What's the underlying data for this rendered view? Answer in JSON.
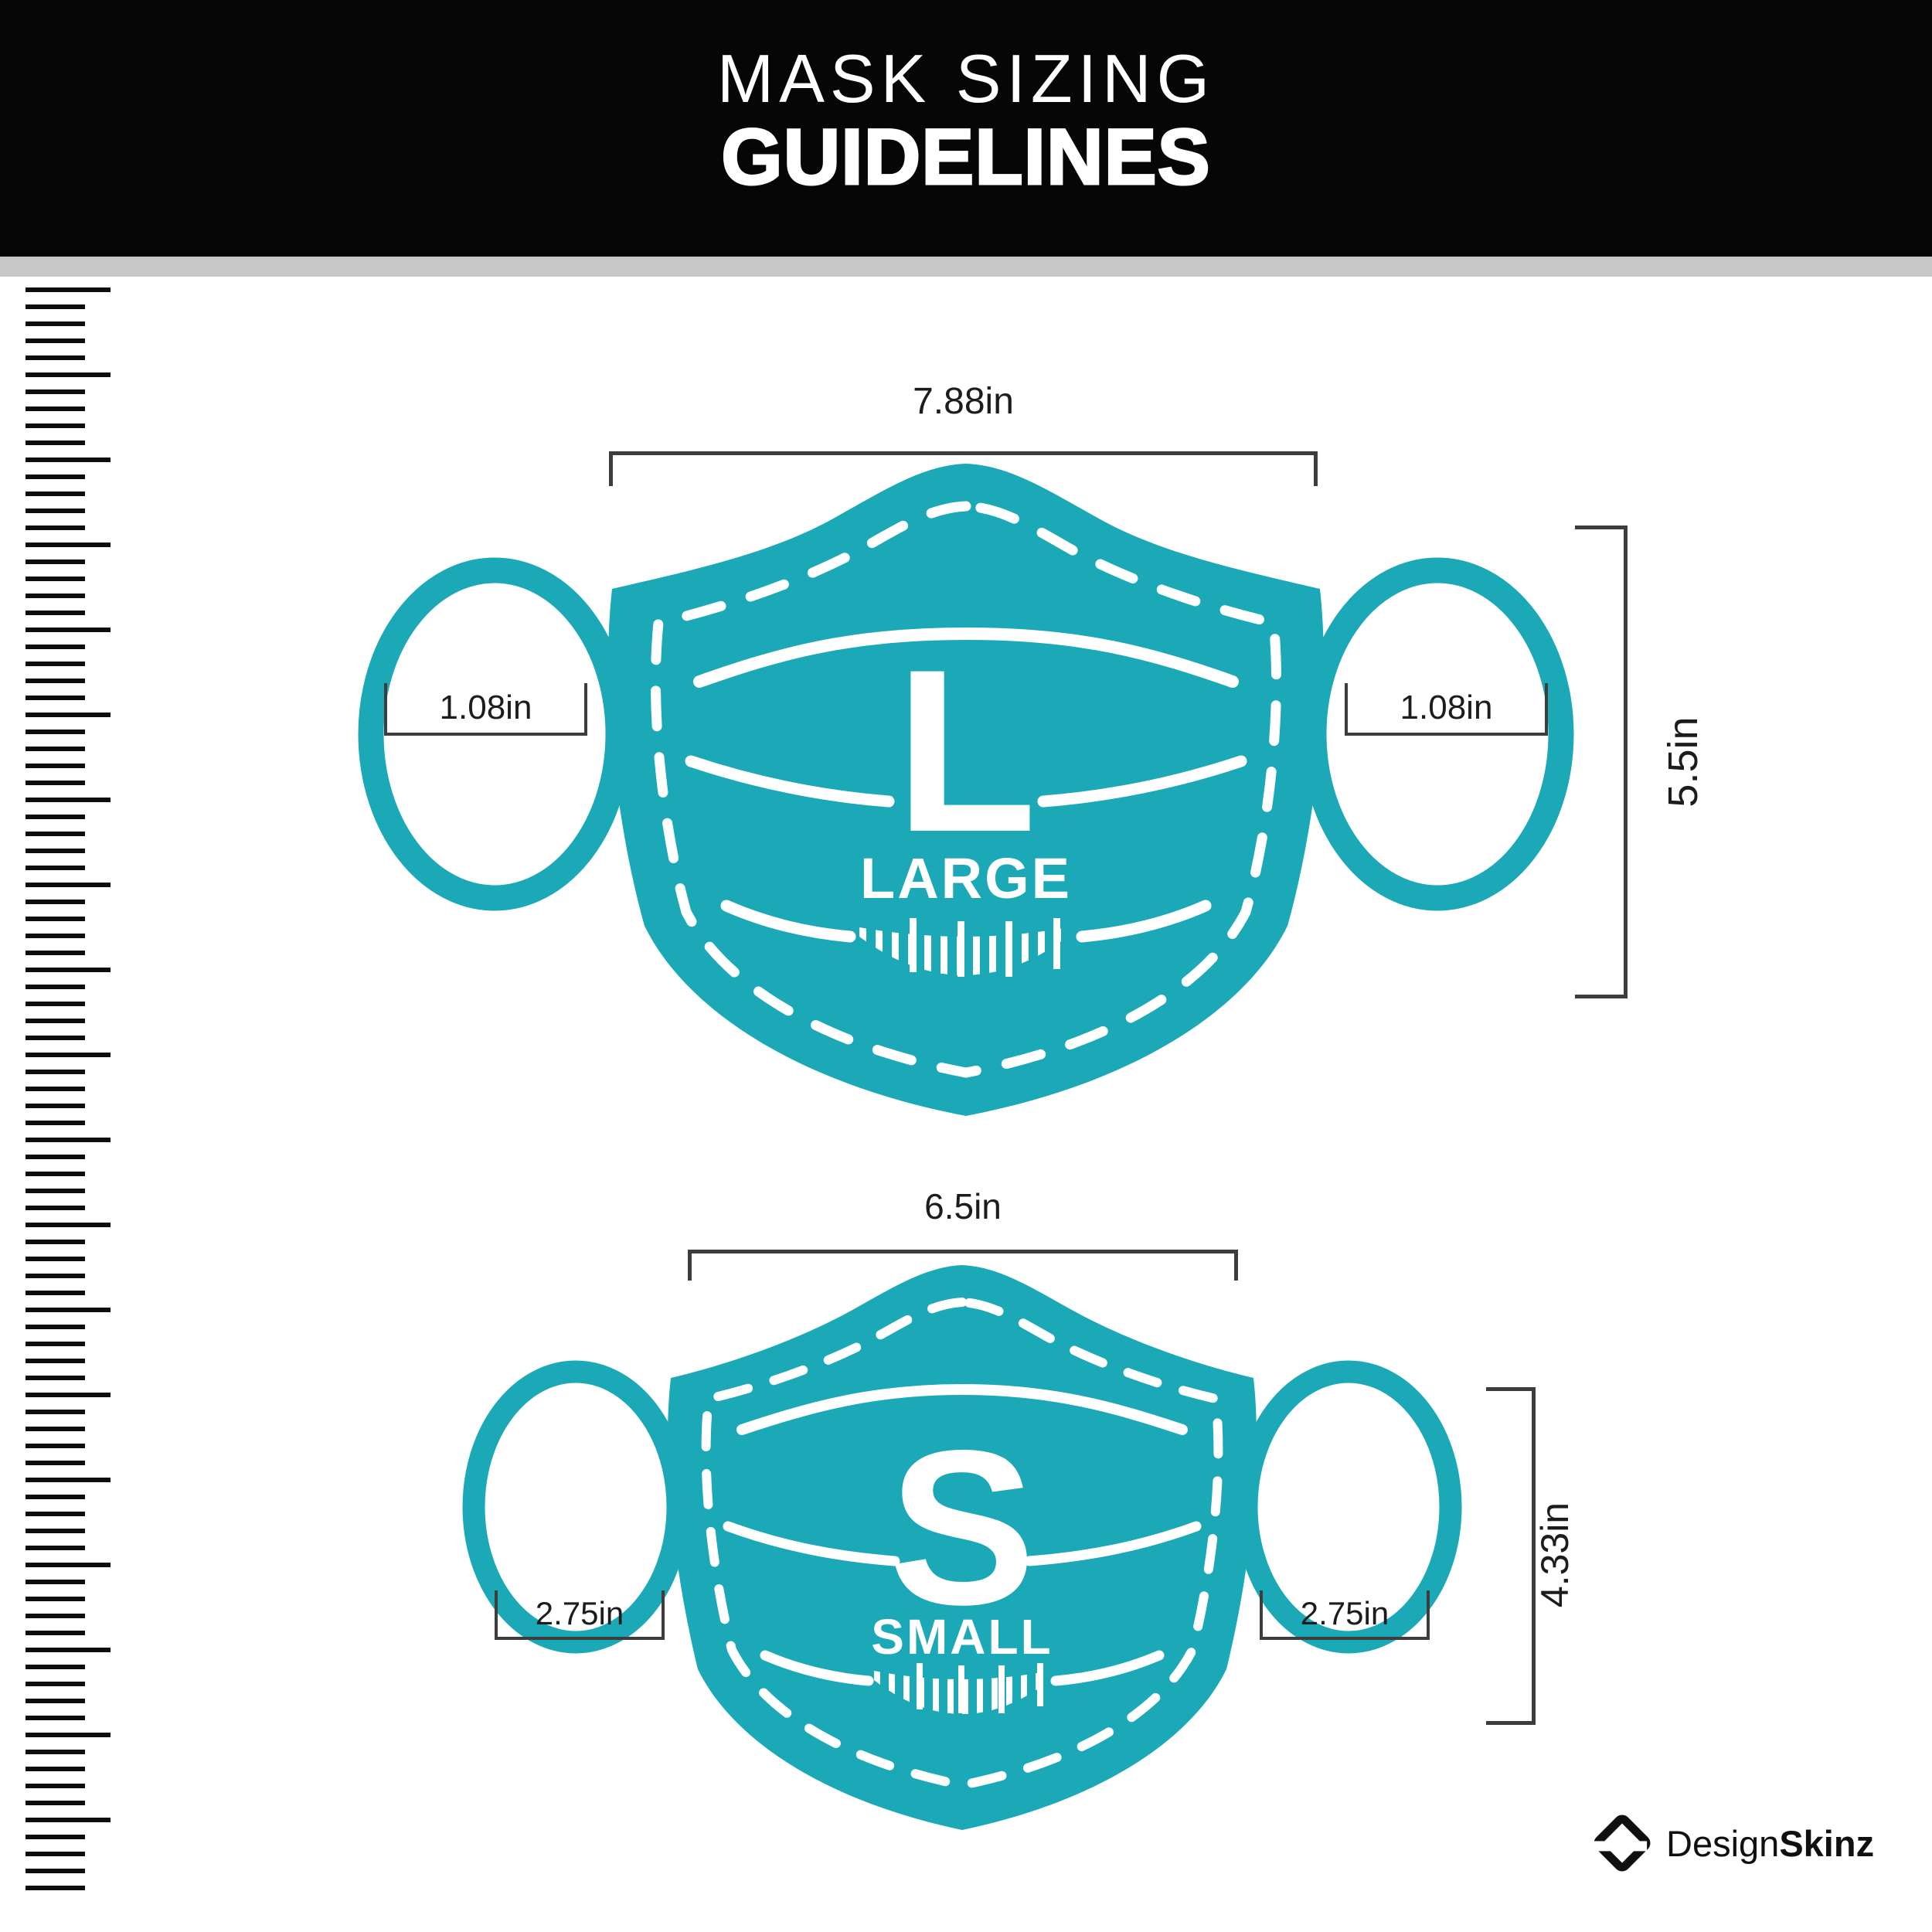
{
  "header": {
    "title_line1": "MASK SIZING",
    "title_line2": "GUIDELINES"
  },
  "masks": [
    {
      "id": "large",
      "letter": "L",
      "name": "LARGE",
      "width": "7.88in",
      "height": "5.5in",
      "ear_left": "1.08in",
      "ear_right": "1.08in"
    },
    {
      "id": "small",
      "letter": "S",
      "name": "SMALL",
      "width": "6.5in",
      "height": "4.33in",
      "ear_left": "2.75in",
      "ear_right": "2.75in"
    }
  ],
  "footer": {
    "brand_regular": "Design",
    "brand_bold": "Skinz"
  },
  "colors": {
    "mask_teal": "#1ba9b8",
    "line_dark": "#3d3d3d",
    "banner_black": "#060606",
    "divider_gray": "#c7c7c7"
  },
  "icons": {
    "ruler": "ruler-icon",
    "brand_mark": "designskinz-diamond-icon"
  }
}
